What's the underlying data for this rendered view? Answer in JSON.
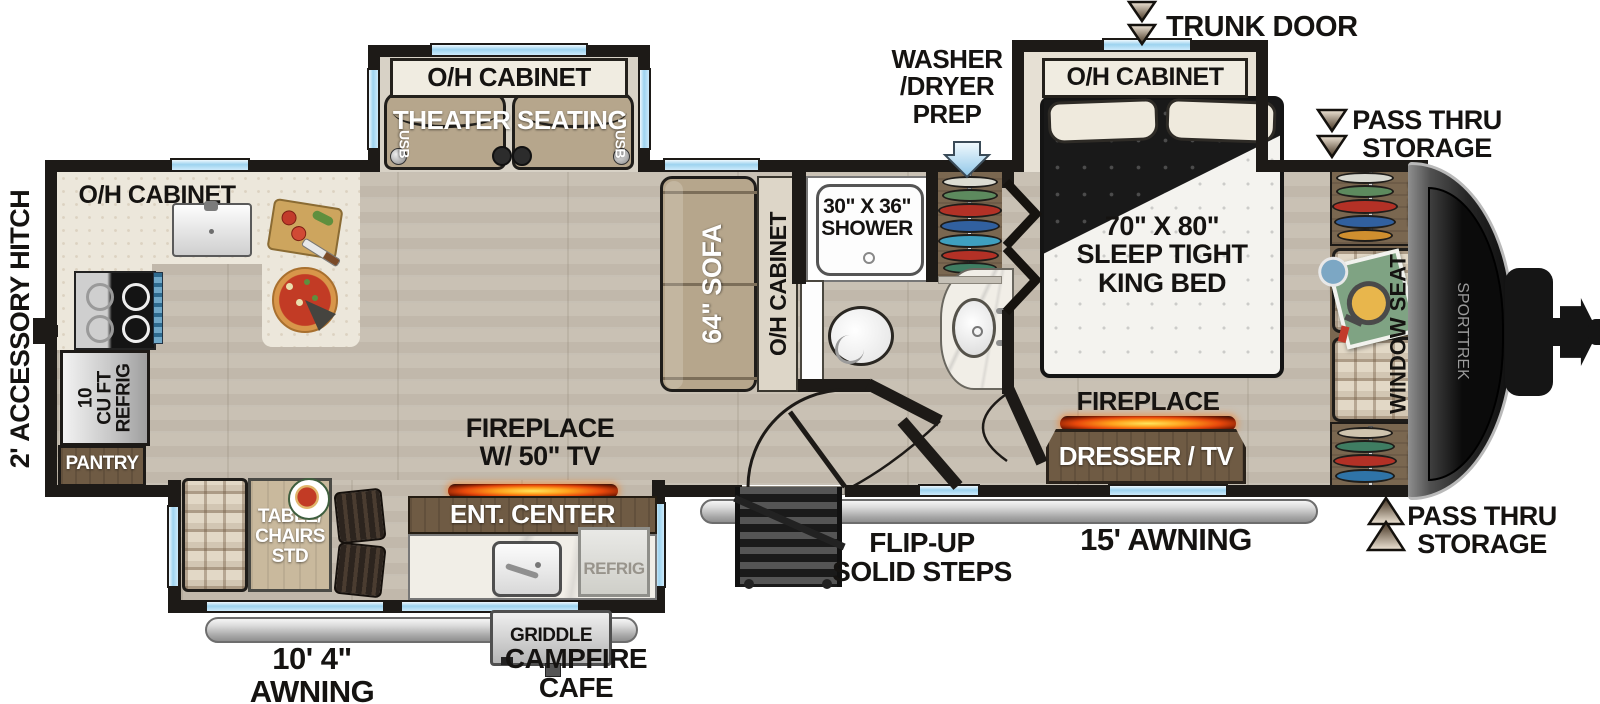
{
  "exterior": {
    "accessory_hitch": "2' ACCESSORY HITCH",
    "trunk_door": "TRUNK DOOR",
    "pass_thru_top": "PASS THRU\nSTORAGE",
    "pass_thru_bottom": "PASS THRU\nSTORAGE",
    "washer_dryer_prep": "WASHER\n/DRYER\nPREP",
    "flip_up_steps": "FLIP-UP\nSOLID STEPS",
    "awning_main": "15' AWNING",
    "awning_rear": "10' 4\" AWNING",
    "campfire_cafe": "CAMPFIRE\nCAFE",
    "griddle": "GRIDDLE",
    "brand": "SPORTTREK"
  },
  "kitchen": {
    "oh_cabinet": "O/H CABINET",
    "refrig": "10\nCU FT\nREFRIG",
    "pantry": "PANTRY"
  },
  "living": {
    "theater_oh_cabinet": "O/H CABINET",
    "theater_seating": "THEATER SEATING",
    "usb": "USB",
    "sofa": "64\" SOFA",
    "sofa_oh_cabinet": "O/H CABINET",
    "fireplace_tv": "FIREPLACE\nW/ 50\" TV",
    "ent_center": "ENT. CENTER",
    "refrig_small": "REFRIG",
    "table_chairs": "TABLE/\nCHAIRS\nSTD"
  },
  "bath": {
    "shower": "30\" X 36\"\nSHOWER"
  },
  "bedroom": {
    "oh_cabinet": "O/H CABINET",
    "bed": "70\" X 80\"\nSLEEP TIGHT\nKING BED",
    "fireplace": "FIREPLACE",
    "dresser_tv": "DRESSER / TV",
    "shelf": "SHELF",
    "window_seat": "WINDOW SEAT"
  },
  "colors": {
    "wall": "#1d1a17",
    "floor": "#c9c1b4",
    "window_blue": "#9dd3ef",
    "counter": "#ece7db",
    "cabinet_brown": "#6f5b44",
    "furniture_tan": "#b6a68c",
    "fireplace_glow": "#ff7c1e",
    "awning_gray": "#c9c9c9",
    "arrow_tan": "#c9b7a0",
    "washer_arrow_blue": "#bfe2f8"
  }
}
